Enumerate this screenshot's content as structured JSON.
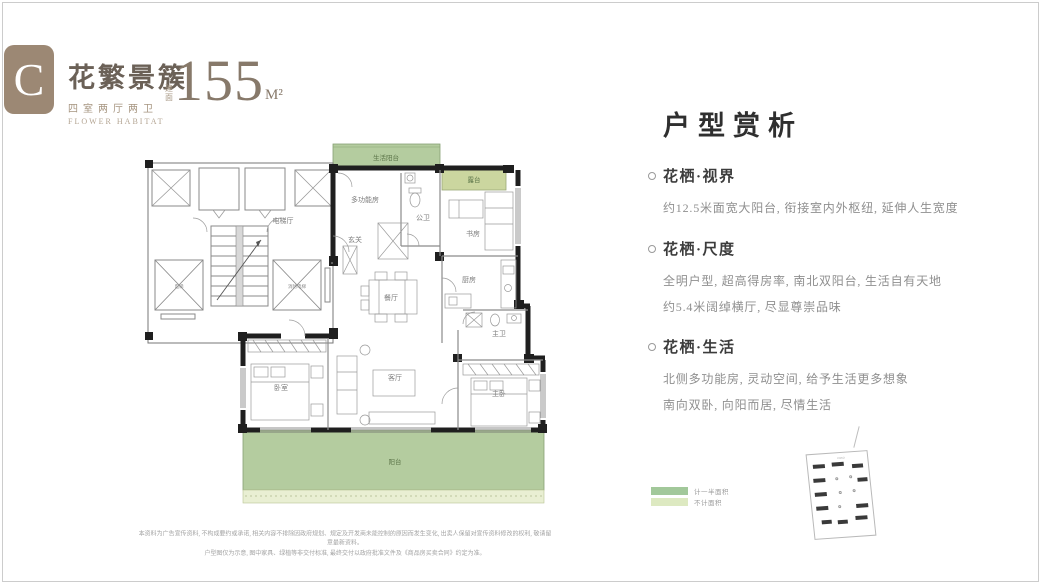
{
  "header": {
    "badge_letter": "C",
    "title": "花繁景簇",
    "subtitle": "四室两厅两卫",
    "subtitle_en": "FLOWER HABITAT",
    "area_prefix": "建面",
    "area_value": "155",
    "area_unit": "M²"
  },
  "analysis": {
    "heading": "户型赏析",
    "sections": [
      {
        "title": "花栖·视界",
        "line1": "约12.5米面宽大阳台, 衔接室内外枢纽, 延伸人生宽度",
        "line2": ""
      },
      {
        "title": "花栖·尺度",
        "line1": "全明户型, 超高得房率, 南北双阳台, 生活自有天地",
        "line2": "约5.4米阔绰横厅, 尽显尊崇品味"
      },
      {
        "title": "花栖·生活",
        "line1": "北侧多功能房, 灵动空间, 给予生活更多想象",
        "line2": "南向双卧, 向阳而居, 尽情生活"
      }
    ]
  },
  "floorplan": {
    "rooms": {
      "life_balcony": "生活阳台",
      "terrace": "露台",
      "multifunction": "多功能房",
      "public_bath": "公卫",
      "foyer": "玄关",
      "study": "书房",
      "kitchen": "厨房",
      "dining": "餐厅",
      "elevator_hall": "电梯厅",
      "elevator": "电梯",
      "fire_elevator": "消防电梯",
      "bedroom": "卧室",
      "living": "客厅",
      "master_bedroom": "主卧",
      "master_bath": "主卫",
      "balcony": "阳台"
    },
    "colors": {
      "balcony_green": "#b4cc9f",
      "terrace_green": "#cbd69f",
      "pale_strip": "#e9efd3",
      "wall": "#1f1f1f"
    }
  },
  "legend": {
    "items": [
      {
        "label": "计一半面积",
        "color": "#a2c89a"
      },
      {
        "label": "不计面积",
        "color": "#dde9c1"
      }
    ]
  },
  "disclaimer": {
    "line1": "本资料为广告宣传资料, 不构成要约或承诺, 相关内容不排除因政府规划、规定及开发商未能控制的原因而发生变化, 出卖人保留对宣传资料修改的权利, 敬请留意最新资料。",
    "line2": "户型图仅为示意, 图中家具、绿植等非交付标准, 最终交付以政府批准文件及《商品房买卖合同》约定为准。"
  }
}
